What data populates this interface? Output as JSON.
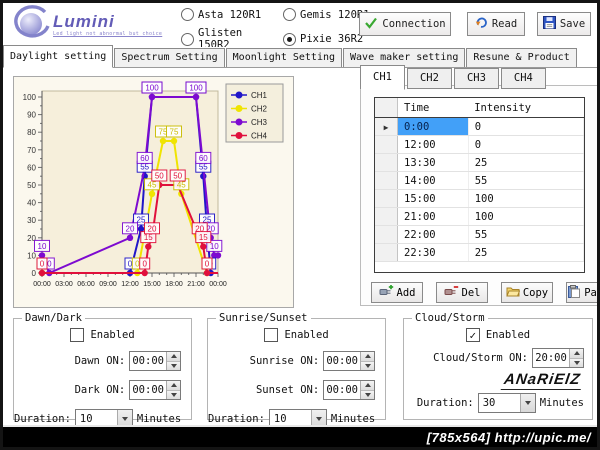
{
  "window": {
    "statusbar_text": "[785x564] http://upic.me/"
  },
  "header": {
    "logo": {
      "brand": "Lumini",
      "tagline": "Led light not abnormal but choice"
    },
    "models": [
      {
        "label": "Asta 120R1",
        "selected": false
      },
      {
        "label": "Gemis 120R1",
        "selected": false
      },
      {
        "label": "Glisten 150R2",
        "selected": false
      },
      {
        "label": "Pixie 36R2",
        "selected": true
      }
    ],
    "buttons": {
      "connection": "Connection",
      "read": "Read",
      "save": "Save"
    }
  },
  "tabs": [
    {
      "label": "Daylight setting",
      "active": true
    },
    {
      "label": "Spectrum Setting",
      "active": false
    },
    {
      "label": "Moonlight Setting",
      "active": false
    },
    {
      "label": "Wave maker setting",
      "active": false
    },
    {
      "label": "Resune & Product",
      "active": false
    }
  ],
  "chart_data": {
    "type": "line",
    "title": "",
    "x_tick_labels": [
      "00:00",
      "03:00",
      "06:00",
      "09:00",
      "12:00",
      "15:00",
      "18:00",
      "21:00",
      "00:00"
    ],
    "x_range_hours": [
      0,
      24
    ],
    "ylim": [
      0,
      100
    ],
    "y_tick_step": 10,
    "grid": false,
    "legend_position": "right",
    "series": [
      {
        "name": "CH1",
        "color": "#2016c8",
        "points": [
          [
            0,
            0
          ],
          [
            12,
            0
          ],
          [
            13.5,
            25
          ],
          [
            14,
            55
          ],
          [
            15,
            100
          ],
          [
            21,
            100
          ],
          [
            22,
            55
          ],
          [
            22.5,
            25
          ],
          [
            23,
            0
          ]
        ]
      },
      {
        "name": "CH2",
        "color": "#f0e400",
        "points": [
          [
            0,
            0
          ],
          [
            13,
            0
          ],
          [
            15,
            45
          ],
          [
            16.5,
            75
          ],
          [
            18,
            75
          ],
          [
            19,
            45
          ],
          [
            22.5,
            0
          ]
        ]
      },
      {
        "name": "CH3",
        "color": "#7d0ad0",
        "points": [
          [
            0,
            10
          ],
          [
            1,
            0
          ],
          [
            12,
            20
          ],
          [
            14,
            60
          ],
          [
            15,
            100
          ],
          [
            21,
            100
          ],
          [
            22,
            60
          ],
          [
            23,
            20
          ],
          [
            23.5,
            10
          ],
          [
            24,
            10
          ]
        ]
      },
      {
        "name": "CH4",
        "color": "#e0103c",
        "points": [
          [
            0,
            0
          ],
          [
            14,
            0
          ],
          [
            14.5,
            15
          ],
          [
            15,
            20
          ],
          [
            16,
            50
          ],
          [
            18.5,
            50
          ],
          [
            21.5,
            20
          ],
          [
            22,
            15
          ],
          [
            22.5,
            0
          ]
        ]
      }
    ]
  },
  "channel_panel": {
    "tabs": [
      "CH1",
      "CH2",
      "CH3",
      "CH4"
    ],
    "active_tab": "CH1",
    "table": {
      "columns": [
        "Time",
        "Intensity"
      ],
      "selected_row": 0,
      "rows": [
        [
          "0:00",
          "0"
        ],
        [
          "12:00",
          "0"
        ],
        [
          "13:30",
          "25"
        ],
        [
          "14:00",
          "55"
        ],
        [
          "15:00",
          "100"
        ],
        [
          "21:00",
          "100"
        ],
        [
          "22:00",
          "55"
        ],
        [
          "22:30",
          "25"
        ]
      ]
    },
    "buttons": [
      {
        "label": "Add",
        "icon": "add-plug-icon"
      },
      {
        "label": "Del",
        "icon": "del-plug-icon"
      },
      {
        "label": "Copy",
        "icon": "copy-folder-icon"
      },
      {
        "label": "Paste",
        "icon": "paste-clipboard-icon"
      }
    ]
  },
  "groups": {
    "dawn_dark": {
      "title": "Dawn/Dark",
      "enabled_label": "Enabled",
      "enabled": false,
      "fields": [
        {
          "label": "Dawn ON:",
          "value": "00:00"
        },
        {
          "label": "Dark ON:",
          "value": "00:00"
        }
      ],
      "duration_label": "Duration:",
      "duration": "10",
      "unit": "Minutes"
    },
    "sunrise_sunset": {
      "title": "Sunrise/Sunset",
      "enabled_label": "Enabled",
      "enabled": false,
      "fields": [
        {
          "label": "Sunrise ON:",
          "value": "00:00"
        },
        {
          "label": "Sunset ON:",
          "value": "00:00"
        }
      ],
      "duration_label": "Duration:",
      "duration": "10",
      "unit": "Minutes"
    },
    "cloud_storm": {
      "title": "Cloud/Storm",
      "enabled_label": "Enabled",
      "enabled": true,
      "fields": [
        {
          "label": "Cloud/Storm ON:",
          "value": "20:00"
        }
      ],
      "signature": "ANaRiElZ",
      "duration_label": "Duration:",
      "duration": "30",
      "unit": "Minutes"
    }
  }
}
